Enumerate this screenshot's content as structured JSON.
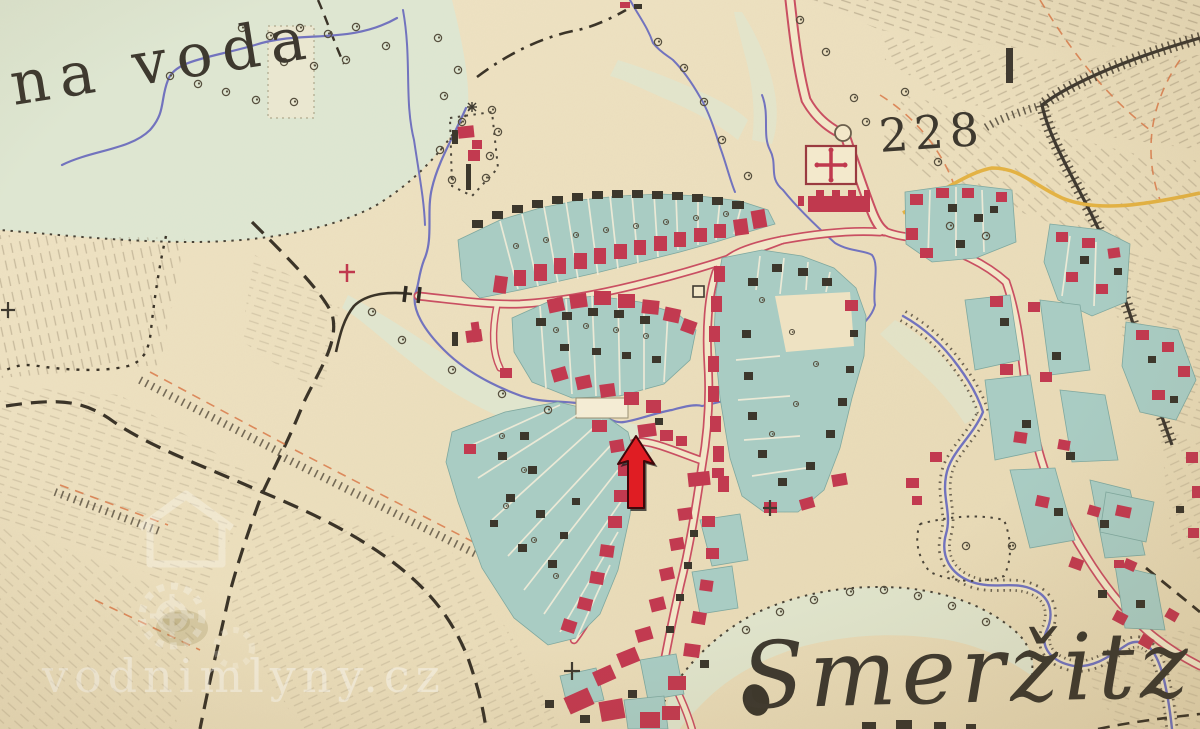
{
  "map": {
    "region_label": "na voda",
    "elevation_marker": "228",
    "settlement_name": "Smeržitz"
  },
  "watermark": {
    "text": "vodnimlyny.cz"
  },
  "annotation_arrow": {
    "shape": "arrow-up",
    "color": "#e01d23"
  },
  "palette": {
    "paper": "#ecdfbd",
    "meadow": "#dde8d4",
    "garden_parcel": "#a9ccc3",
    "masonry_building": "#c23a50",
    "wooden_building": "#3c372c",
    "road_edge": "#c94f62",
    "road_yellow": "#e3b244",
    "water": "#7273be",
    "ink": "#3e392f"
  }
}
